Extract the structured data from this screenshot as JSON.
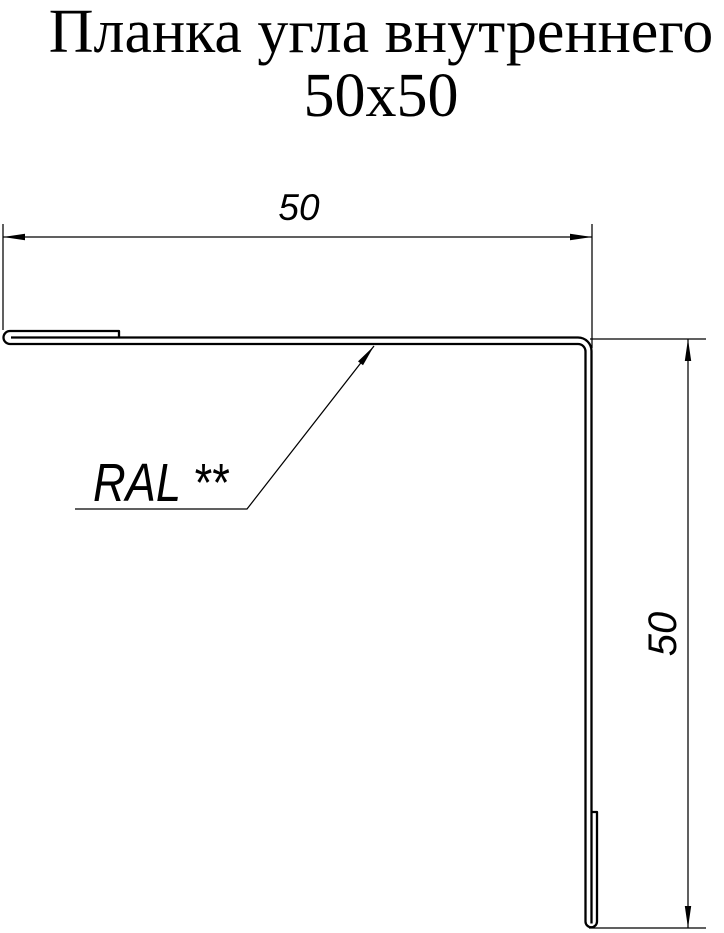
{
  "title": {
    "line1": "Планка угла внутреннего",
    "line2": "50х50"
  },
  "drawing": {
    "dimension_horizontal": {
      "value": "50"
    },
    "dimension_vertical": {
      "value": "50"
    },
    "coating_label": "RAL **"
  },
  "colors": {
    "line": "#000000",
    "background": "#ffffff"
  }
}
